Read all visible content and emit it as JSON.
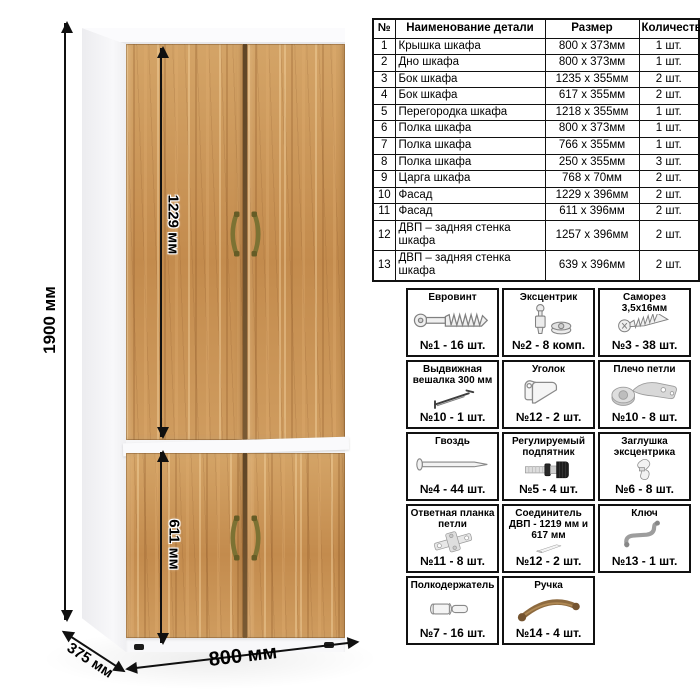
{
  "scene": {
    "dimensions": {
      "total_height": "1900 мм",
      "upper_door_height": "1229 мм",
      "lower_door_height": "611 мм",
      "depth": "375 мм",
      "width": "800 мм"
    }
  },
  "parts_table": {
    "headers": [
      "№",
      "Наименование детали",
      "Размер",
      "Количество"
    ],
    "rows": [
      [
        "1",
        "Крышка шкафа",
        "800 x 373мм",
        "1 шт."
      ],
      [
        "2",
        "Дно шкафа",
        "800 x 373мм",
        "1 шт."
      ],
      [
        "3",
        "Бок шкафа",
        "1235 x 355мм",
        "2 шт."
      ],
      [
        "4",
        "Бок шкафа",
        "617 x 355мм",
        "2 шт."
      ],
      [
        "5",
        "Перегородка шкафа",
        "1218 x 355мм",
        "1 шт."
      ],
      [
        "6",
        "Полка шкафа",
        "800 x 373мм",
        "1 шт."
      ],
      [
        "7",
        "Полка шкафа",
        "766 x 355мм",
        "1 шт."
      ],
      [
        "8",
        "Полка шкафа",
        "250 x 355мм",
        "3 шт."
      ],
      [
        "9",
        "Царга шкафа",
        "768 x 70мм",
        "2 шт."
      ],
      [
        "10",
        "Фасад",
        "1229 x 396мм",
        "2 шт."
      ],
      [
        "11",
        "Фасад",
        "611 x 396мм",
        "2 шт."
      ],
      [
        "12",
        "ДВП – задняя стенка шкафа",
        "1257 x 396мм",
        "2 шт."
      ],
      [
        "13",
        "ДВП – задняя стенка шкафа",
        "639 x 396мм",
        "2 шт."
      ]
    ]
  },
  "hardware": {
    "items": [
      {
        "title": "Евровинт",
        "icon": "euro-screw",
        "count": "№1 - 16 шт."
      },
      {
        "title": "Эксцентрик",
        "icon": "cam-lock",
        "count": "№2 - 8 комп."
      },
      {
        "title": "Саморез 3,5х16мм",
        "icon": "self-tapping-screw",
        "count": "№3 - 38 шт."
      },
      {
        "title": "Выдвижная вешалка 300 мм",
        "icon": "pullout-hanger",
        "count": "№10 - 1 шт."
      },
      {
        "title": "Уголок",
        "icon": "corner-bracket",
        "count": "№12 - 2 шт."
      },
      {
        "title": "Плечо петли",
        "icon": "hinge-arm",
        "count": "№10 - 8 шт."
      },
      {
        "title": "Гвоздь",
        "icon": "nail",
        "count": "№4 - 44 шт."
      },
      {
        "title": "Регулируемый подпятник",
        "icon": "adjustable-foot",
        "count": "№5 - 4 шт."
      },
      {
        "title": "Заглушка эксцентрика",
        "icon": "cam-cap",
        "count": "№6 - 8 шт."
      },
      {
        "title": "Ответная планка петли",
        "icon": "hinge-plate",
        "count": "№11 - 8 шт."
      },
      {
        "title": "Соединитель ДВП - 1219 мм и 617 мм",
        "icon": "hdf-connector",
        "count": "№12 - 2 шт."
      },
      {
        "title": "Ключ",
        "icon": "hex-key",
        "count": "№13 - 1 шт."
      },
      {
        "title": "Полкодержатель",
        "icon": "shelf-pin",
        "count": "№7 - 16 шт."
      },
      {
        "title": "Ручка",
        "icon": "handle",
        "count": "№14 - 4 шт."
      }
    ]
  },
  "colors": {
    "wood": "#c9914f",
    "carcass": "#f7f7f8",
    "handle_bronze": "#7c7233",
    "line": "#111111",
    "text": "#000000"
  }
}
